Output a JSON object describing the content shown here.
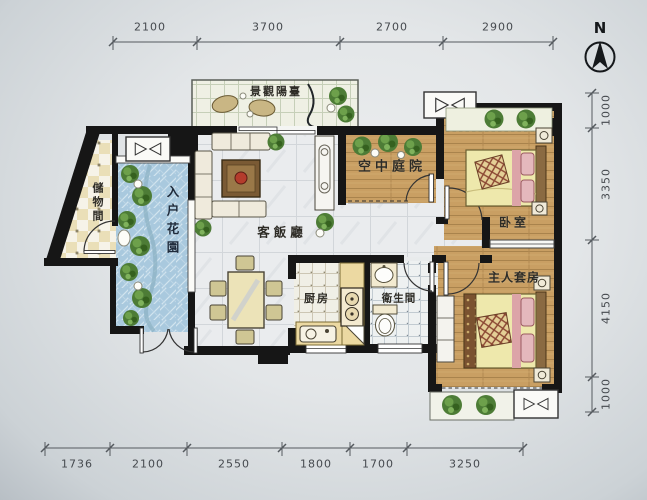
{
  "compass": {
    "label": "N"
  },
  "dimensions": {
    "top": [
      "2100",
      "3700",
      "2700",
      "2900"
    ],
    "right": [
      "1000",
      "3350",
      "4150",
      "1000"
    ],
    "bottom": [
      "1736",
      "2100",
      "2550",
      "1800",
      "1700",
      "3250"
    ]
  },
  "rooms": {
    "balcony": "景觀陽臺",
    "storage": "儲物間",
    "entry_garden": "入户花園",
    "living_dining": "客飯廳",
    "sky_courtyard": "空中庭院",
    "bedroom": "卧室",
    "master_suite": "主人套房",
    "kitchen": "厨房",
    "bathroom": "衛生間"
  },
  "colors": {
    "wall": "#161616",
    "wood_floor": "#c99f63",
    "marble_floor": "#eaecee",
    "garden_tile": "#a9c9de",
    "plant_green": "#4d7c36",
    "dimension_text": "#45494e"
  }
}
